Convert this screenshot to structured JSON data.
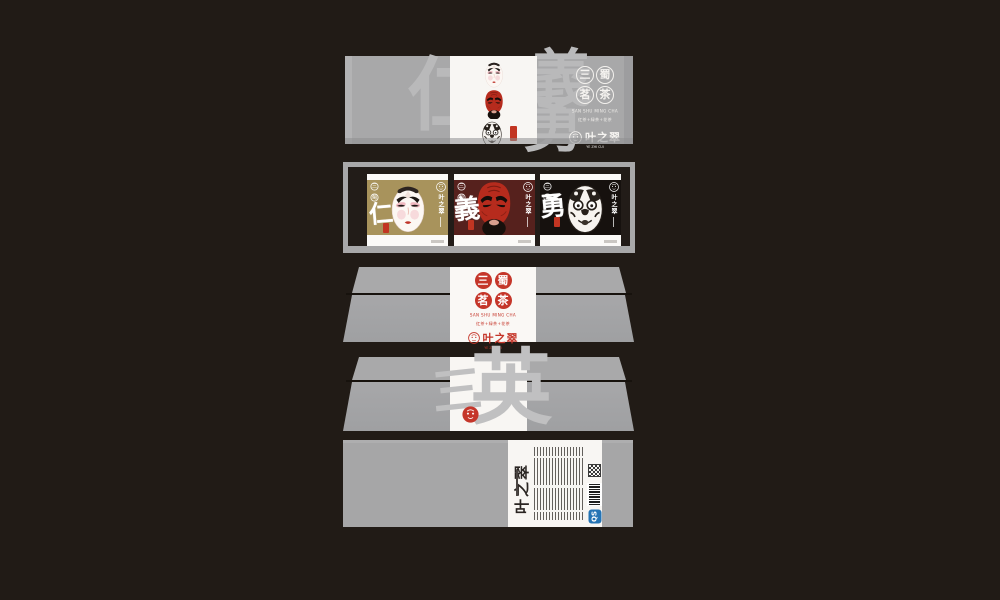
{
  "colors": {
    "background": "#211b16",
    "panel_gray": "#a8a8a9",
    "label_white": "#f8f6f3",
    "accent_red": "#c5362a",
    "gold_card": "#a8935c",
    "maroon_card": "#56211d",
    "black_card": "#16110e",
    "watermark_gray": "#b9b9ba",
    "qs_blue": "#2574b5"
  },
  "brand": {
    "logo_text": "叶之翠",
    "logo_sub": "YE ZHI CUI",
    "series_circles": [
      "三",
      "蜀",
      "茗",
      "茶"
    ],
    "series_pinyin": "SAN SHU MING CHA",
    "series_types": "红茶+绿茶+花茶"
  },
  "lid": {
    "watermark": [
      "仁",
      "義",
      "勇"
    ]
  },
  "cards": [
    {
      "virtue": "仁",
      "bg": "#a8935c",
      "mask": "white-face"
    },
    {
      "virtue": "義",
      "bg": "#56211d",
      "mask": "red-face"
    },
    {
      "virtue": "勇",
      "bg": "#16110e",
      "mask": "black-face"
    }
  ],
  "side_b": {
    "watermark": [
      "三",
      "英"
    ]
  },
  "bottom": {
    "qs_label": "QS"
  }
}
